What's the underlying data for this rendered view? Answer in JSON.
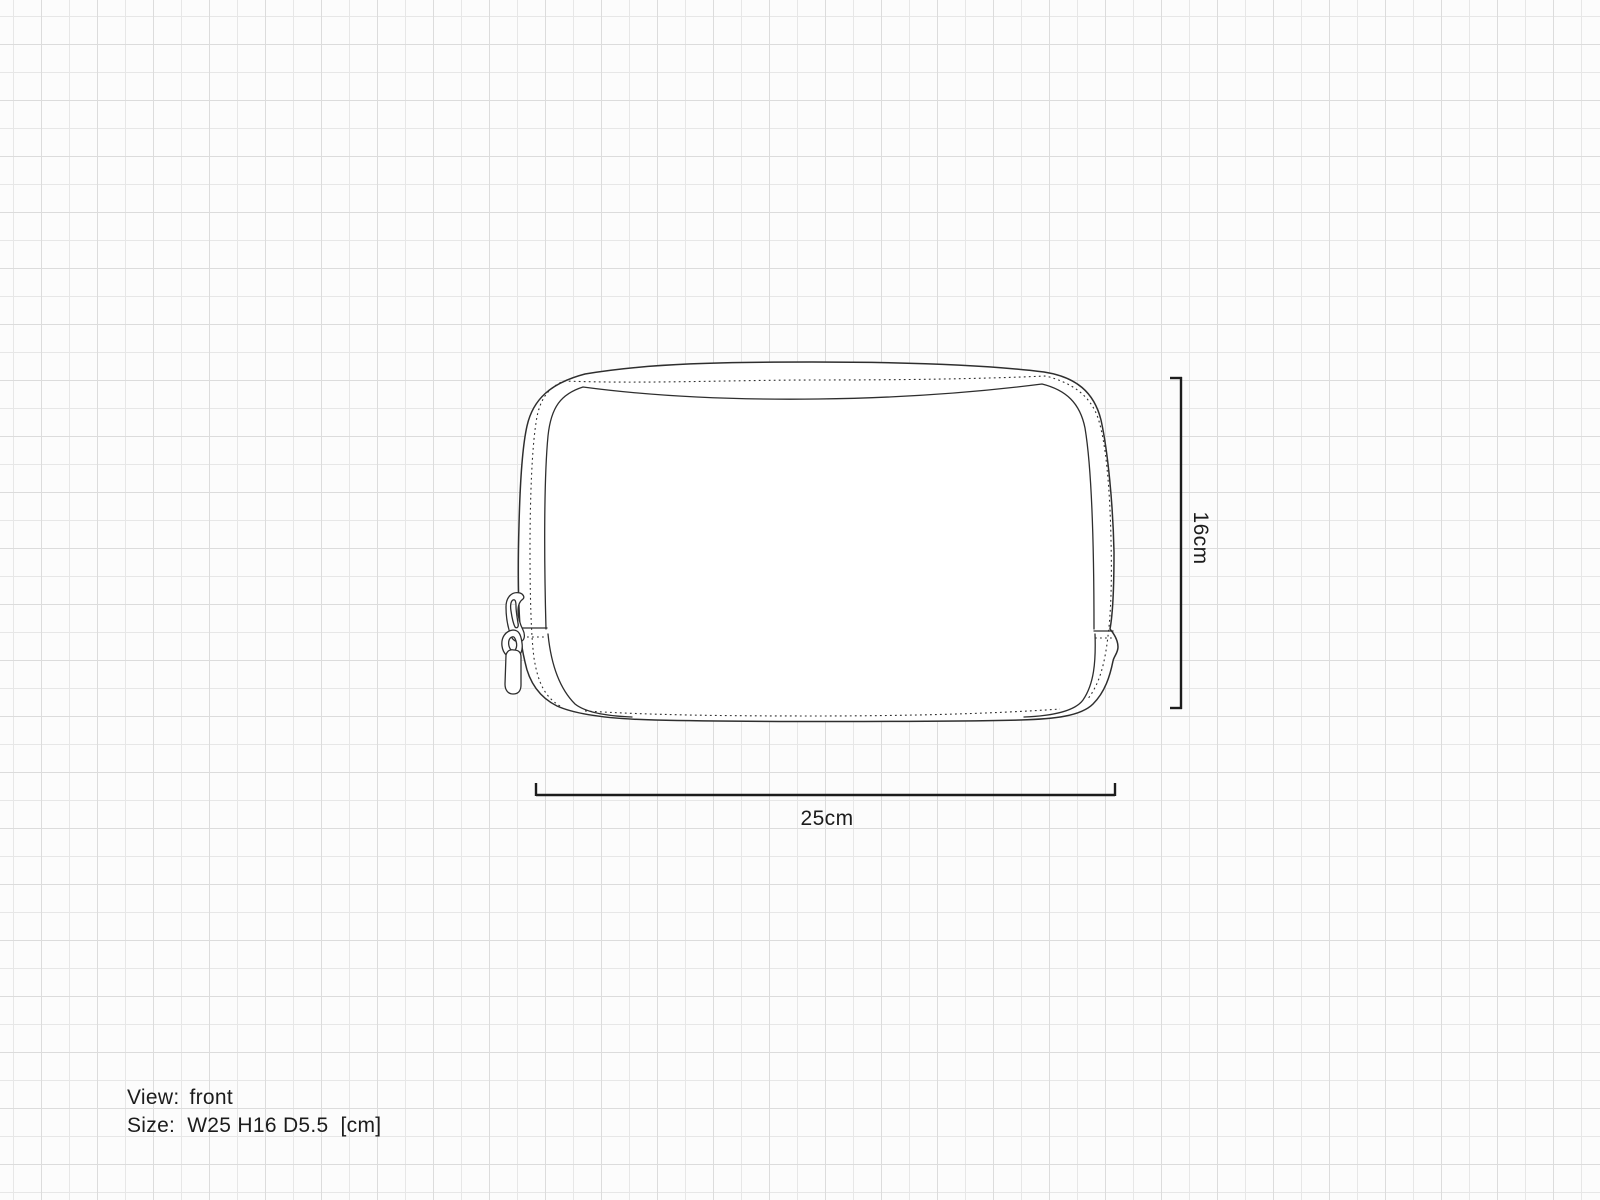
{
  "sketch": {
    "subject": "zip-pouch-front-flat-sketch"
  },
  "dimensions": {
    "width_label": "25cm",
    "height_label": "16cm"
  },
  "footer": {
    "view_label": "View:",
    "view_value": "front",
    "size_label": "Size:",
    "size_value": "W25 H16 D5.5",
    "size_unit": "[cm]"
  },
  "colors": {
    "background": "#fcfcfc",
    "grid_line_minor": "#e7e7e7",
    "grid_line_major": "#dcdcdc",
    "sketch_line": "#2e2e2e",
    "dimension_line": "#1c1c1c",
    "text": "#1c1c1c"
  }
}
